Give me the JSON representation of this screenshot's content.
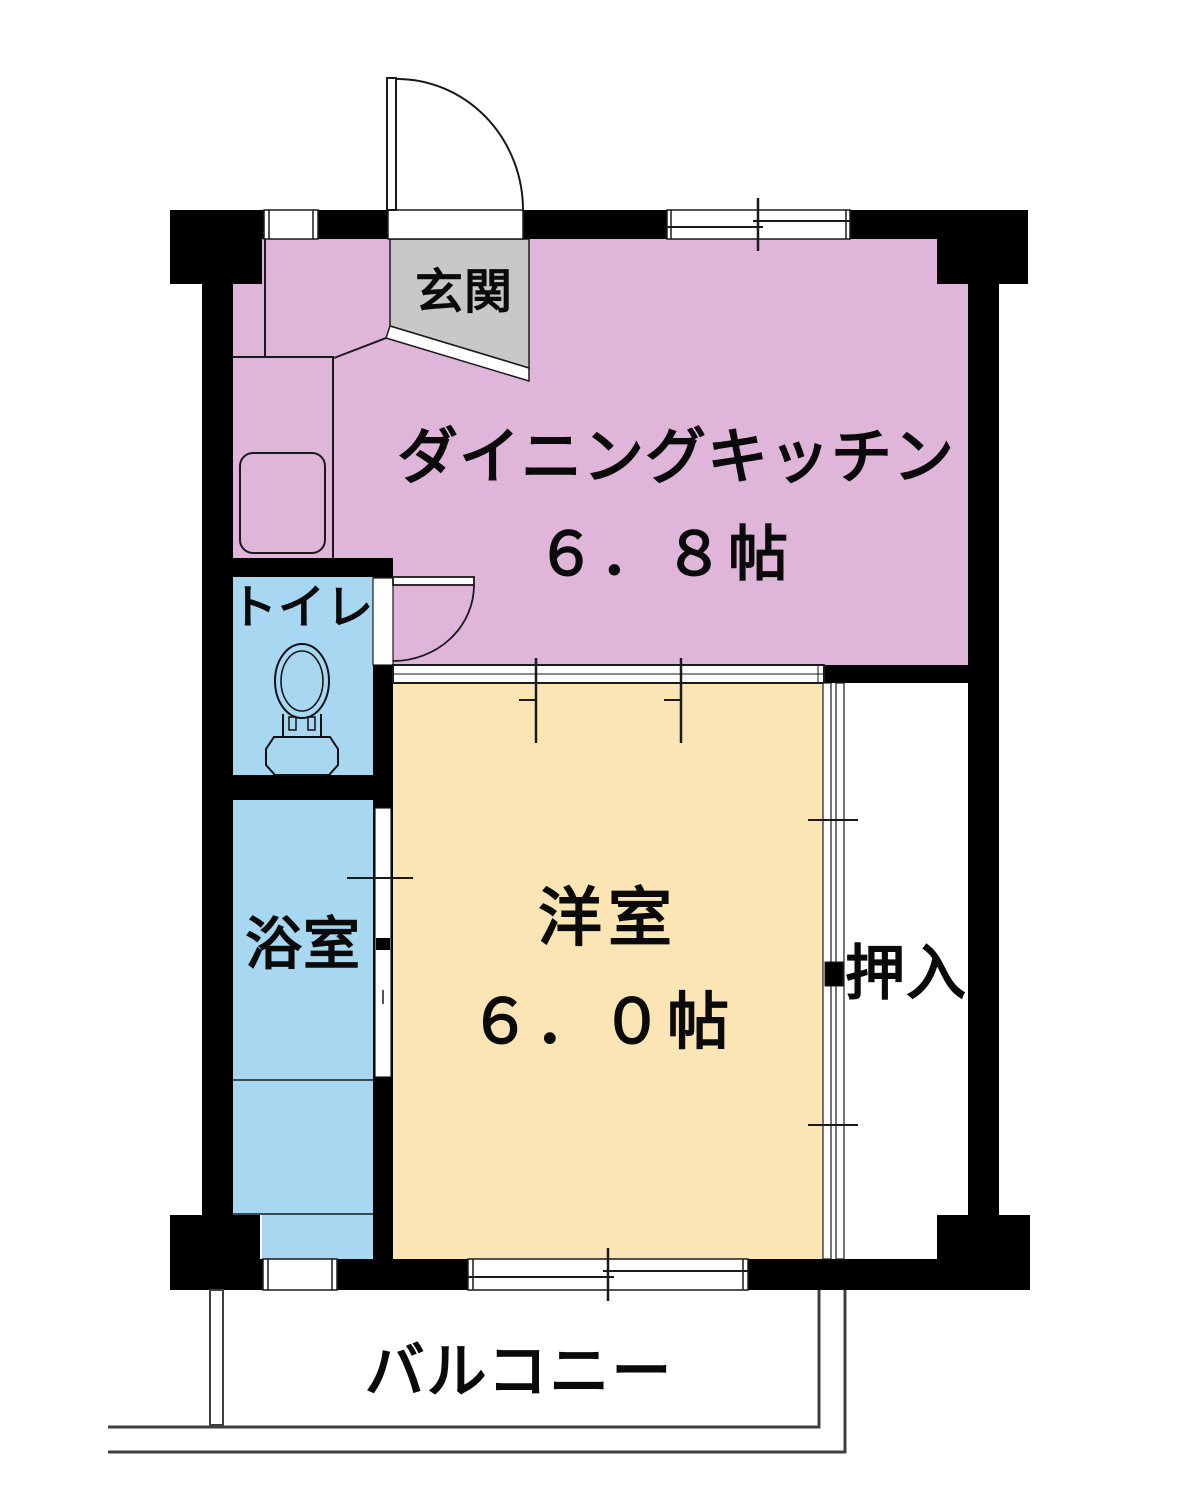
{
  "rooms": {
    "genkan": {
      "label": "玄関"
    },
    "dining_kitchen": {
      "label": "ダイニングキッチン",
      "size": "６．８帖",
      "color": "#dfb6da"
    },
    "toilet": {
      "label": "トイレ",
      "color": "#a8d7f2"
    },
    "bathroom": {
      "label": "浴室",
      "color": "#a8d7f2"
    },
    "western_room": {
      "label": "洋室",
      "size": "６．０帖",
      "color": "#fbe5b4"
    },
    "closet": {
      "label": "押入",
      "color": "#ffffff"
    },
    "balcony": {
      "label": "バルコニー"
    }
  },
  "colors": {
    "wall": "#000000",
    "genkan_floor": "#c8c8c8",
    "line": "#1a1a1a",
    "balcony_line": "#3f3f3f"
  }
}
